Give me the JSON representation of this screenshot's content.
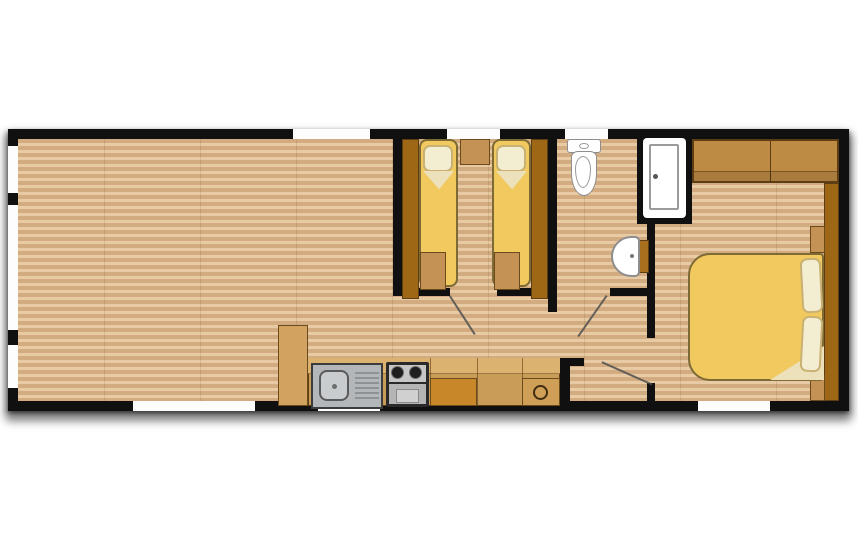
{
  "type": "floorplan",
  "palette": {
    "wall": "#101010",
    "window": "#fdfdfd",
    "floor-a": "#e8cba4",
    "floor-b": "#d2ab80",
    "floor-joint": "rgba(122,78,38,0.16)",
    "bed": "#f1c95e",
    "bed-border": "#7d6a35",
    "pillow": "#f3edd2",
    "pillow-border": "#c9b173",
    "sheet": "#ece1ba",
    "wardrobe": "#9e6716",
    "wood-dark-border": "#5d3e14",
    "cab-mid": "#c49254",
    "cab-border": "#6b4a1c",
    "cab-tan": "#d2a261",
    "cab-orange": "#c8882a",
    "counter": "#c99c58",
    "counter-top": "#dcb271",
    "counter-unit": "#cf9f58",
    "headboard-band": "#bd8b44",
    "steel": "#b4b7b9",
    "steel-light": "#c9ccce",
    "steel-border": "#3c3c3c",
    "stove": "#2a2a2a",
    "hob": "#c6c6c6",
    "burner": "#1e1e1e",
    "silver": "#b5b5b5",
    "silver-light": "#d0d0d0",
    "fixture": "#ffffff",
    "fixture-border": "#8e8e8e",
    "swing-line": "#4f4f4f"
  },
  "fixtures": [
    "lounge-open-floor",
    "kitchen-tall-cabinet",
    "kitchen-counter",
    "kitchen-sink-with-drainer",
    "cooker-hob-and-oven",
    "kitchen-base-cabinet",
    "kitchen-appliance-unit",
    "twin-bed-left",
    "twin-bed-right",
    "twin-wardrobe-left",
    "twin-wardrobe-right",
    "twin-bedside-table",
    "twin-foot-locker-left",
    "twin-foot-locker-right",
    "toilet",
    "shower-enclosure",
    "wash-basin",
    "double-bed",
    "double-bed-pillows",
    "overhead-wardrobe",
    "headboard-unit",
    "headboard-shelves"
  ],
  "openings": {
    "top_windows": 3,
    "bottom_windows": 3,
    "left_windows": 3,
    "door_swings": 3
  }
}
